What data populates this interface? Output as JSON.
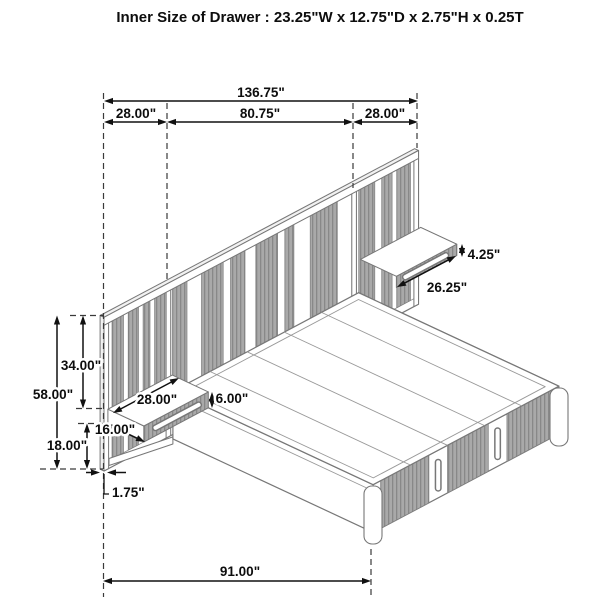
{
  "title": "Inner Size of Drawer : 23.25\"W x 12.75\"D x 2.75\"H x 0.25T",
  "dimensions": {
    "overall_width": "136.75\"",
    "left_panel_width": "28.00\"",
    "center_section_width": "80.75\"",
    "right_panel_width": "28.00\"",
    "right_nightstand_height": "4.25\"",
    "right_nightstand_width": "26.25\"",
    "headboard_upper_height": "34.00\"",
    "overall_height": "58.00\"",
    "left_nightstand_width": "28.00\"",
    "left_nightstand_height": "6.00\"",
    "nightstand_depth": "16.00\"",
    "platform_height": "18.00\"",
    "panel_thickness": "1.75\"",
    "bed_length": "91.00\""
  },
  "colors": {
    "dimension_ink": "#111111",
    "linework": "#777777",
    "slat_fill": "#a9a9a9",
    "background": "#ffffff"
  }
}
